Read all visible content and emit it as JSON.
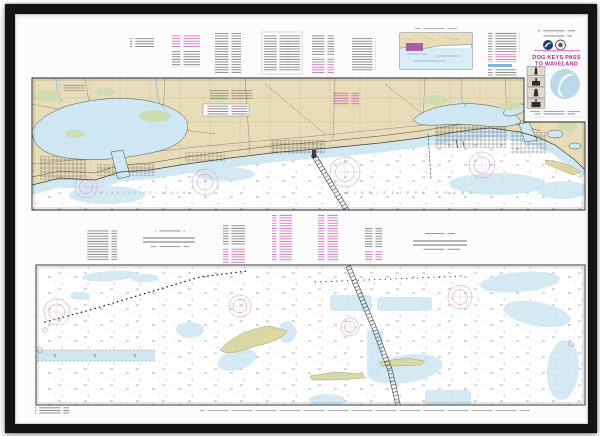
{
  "frame": {
    "color": "#141414",
    "mat_color": "#fcfcfc"
  },
  "chart": {
    "title_block": {
      "title_line1": "DOG KEYS PASS",
      "title_line2": "TO WAVELAND"
    },
    "water_labels": {
      "sound_main": "MISSISSIPPI SOUND",
      "sound_west": "MISSISSIPPI SOUND"
    },
    "colors": {
      "land": "#e9ddb9",
      "marsh": "#ccdbae",
      "island": "#ddd6a4",
      "water_shallow": "#cfe7f2",
      "inset_water": "#d8ecf5",
      "magenta": "#c35ab0",
      "rose": "#d9a0c5",
      "title": "#a82a92",
      "inset_highlight": "#a352a0",
      "noaa_emblem": "#1c3f6e",
      "noaa_watermark": "#bcd9ea",
      "frame": "#141414",
      "mat": "#fcfcfc"
    }
  }
}
